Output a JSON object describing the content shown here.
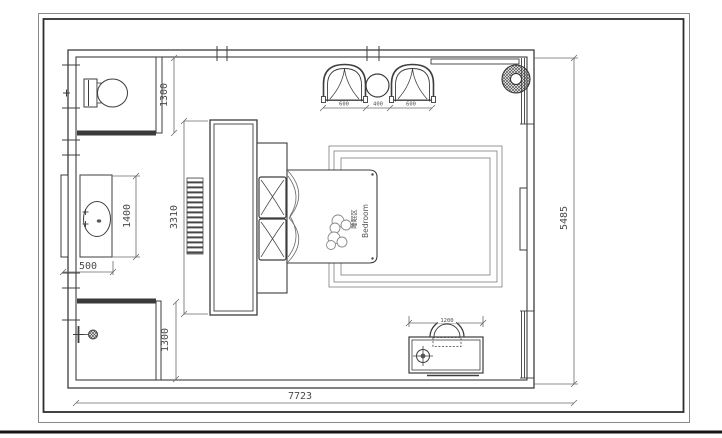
{
  "plan": {
    "labels": {
      "area_cn": "睡眠区",
      "area_en": "Bedroom"
    },
    "dims": {
      "bath_top": "1300",
      "shower": "1300",
      "vanity_len": "1400",
      "vanity_dep": "500",
      "cabinet": "3310",
      "seat_left": "600",
      "seat_table": "400",
      "seat_right": "600",
      "desk": "1200",
      "room_h": "5485",
      "room_w": "7723"
    },
    "icons": [
      "toilet-icon",
      "valve-icon",
      "sink-icon",
      "faucet-icon",
      "shower-icon",
      "armchair-icon",
      "side-table-icon",
      "plant-icon",
      "desk-chair-icon",
      "crosshair-icon"
    ],
    "colors": {
      "line": "#3d3d3d",
      "dim_line": "#6a6a6a",
      "background": "#ffffff",
      "frame_heavy": "#1a1a1a"
    }
  }
}
